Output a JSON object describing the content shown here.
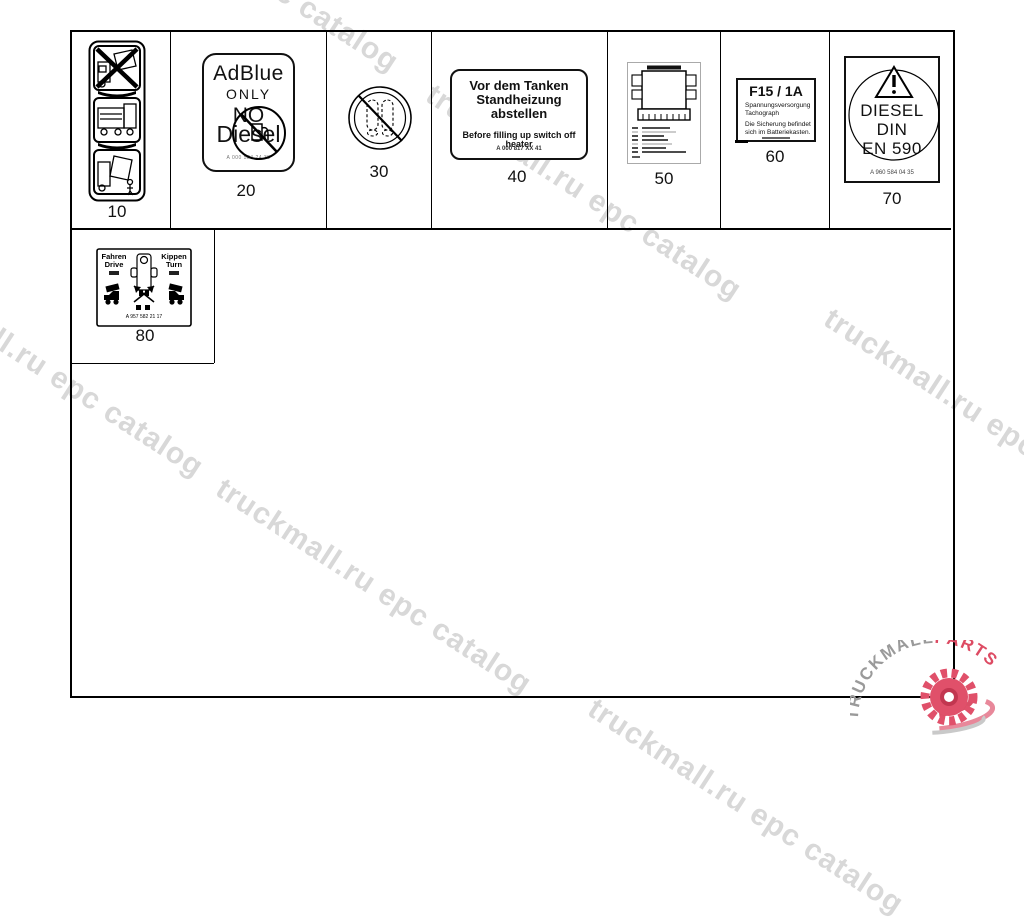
{
  "watermark": {
    "text": "truckmall.ru epc catalog",
    "color": "#d8d8d8"
  },
  "logo": {
    "brand": "TRUCKMALL",
    "suffix": "PARTS",
    "gray": "#9a9a9a",
    "red": "#dd4b63"
  },
  "items": [
    {
      "ref": "10"
    },
    {
      "ref": "20"
    },
    {
      "ref": "30"
    },
    {
      "ref": "40"
    },
    {
      "ref": "50"
    },
    {
      "ref": "60"
    },
    {
      "ref": "70"
    },
    {
      "ref": "80"
    }
  ],
  "label20": {
    "line1": "AdBlue",
    "line2": "ONLY",
    "line3": "NO",
    "line4": "Diesel",
    "part": "A 000 584 24 38"
  },
  "label40": {
    "de1": "Vor dem Tanken",
    "de2": "Standheizung",
    "de3": "abstellen",
    "en": "Before filling up switch off heater",
    "part": "A 000 817 XX 41"
  },
  "label60": {
    "fuse": "F15 / 1A",
    "sub1": "Spannungsversorgung",
    "sub2": "Tachograph",
    "note1": "Die Sicherung befindet",
    "note2": "sich im Batteriekasten."
  },
  "label70": {
    "line1": "DIESEL",
    "line2": "DIN",
    "line3": "EN 590",
    "part": "A 960 584 04 35"
  },
  "label80": {
    "left_de": "Fahren",
    "left_en": "Drive",
    "right_de": "Kippen",
    "right_en": "Turn",
    "part": "A 957 582 21 17"
  }
}
